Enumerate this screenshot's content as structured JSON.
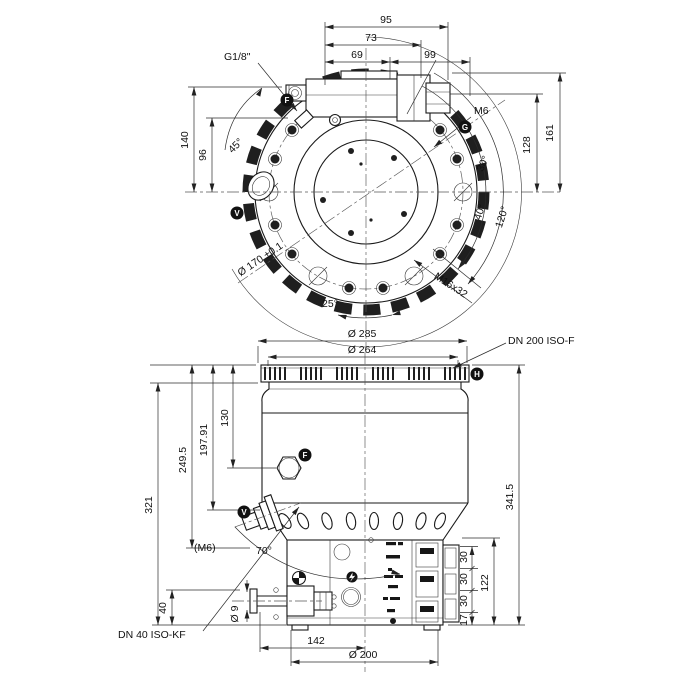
{
  "colors": {
    "line": "#1a1a1a",
    "background": "#ffffff",
    "marker_badge": "#111111"
  },
  "top_view": {
    "dims": {
      "w95": "95",
      "w73": "73",
      "w69": "69",
      "w99": "99",
      "h161": "161",
      "h128": "128",
      "h140": "140",
      "h96": "96"
    },
    "angles": {
      "a45": "45°",
      "a30": "30°",
      "a40": "40°",
      "a120": "120°",
      "a25": "25°"
    },
    "labels": {
      "g18": "G1/8\"",
      "m6": "M6",
      "dia170": "Ø 170 ±0.1",
      "m16x32": "M16x32"
    },
    "markers": {
      "f": "F",
      "g": "G",
      "v": "V"
    }
  },
  "side_view": {
    "dims": {
      "dia285": "Ø 285",
      "dia264": "Ø 264",
      "h130": "130",
      "h19791": "197.91",
      "h2495": "249.5",
      "h321": "321",
      "h3415": "341.5",
      "h122": "122",
      "s30a": "30",
      "s30b": "30",
      "s30c": "30",
      "s17": "17",
      "h40": "40",
      "dia9": "Ø 9",
      "w142": "142",
      "dia200": "Ø 200"
    },
    "angles": {
      "a70": "70°"
    },
    "labels": {
      "dn200": "DN 200 ISO-F",
      "dn40": "DN 40 ISO-KF",
      "m6": "(M6)"
    },
    "markers": {
      "f": "F",
      "v": "V",
      "h": "H"
    }
  }
}
